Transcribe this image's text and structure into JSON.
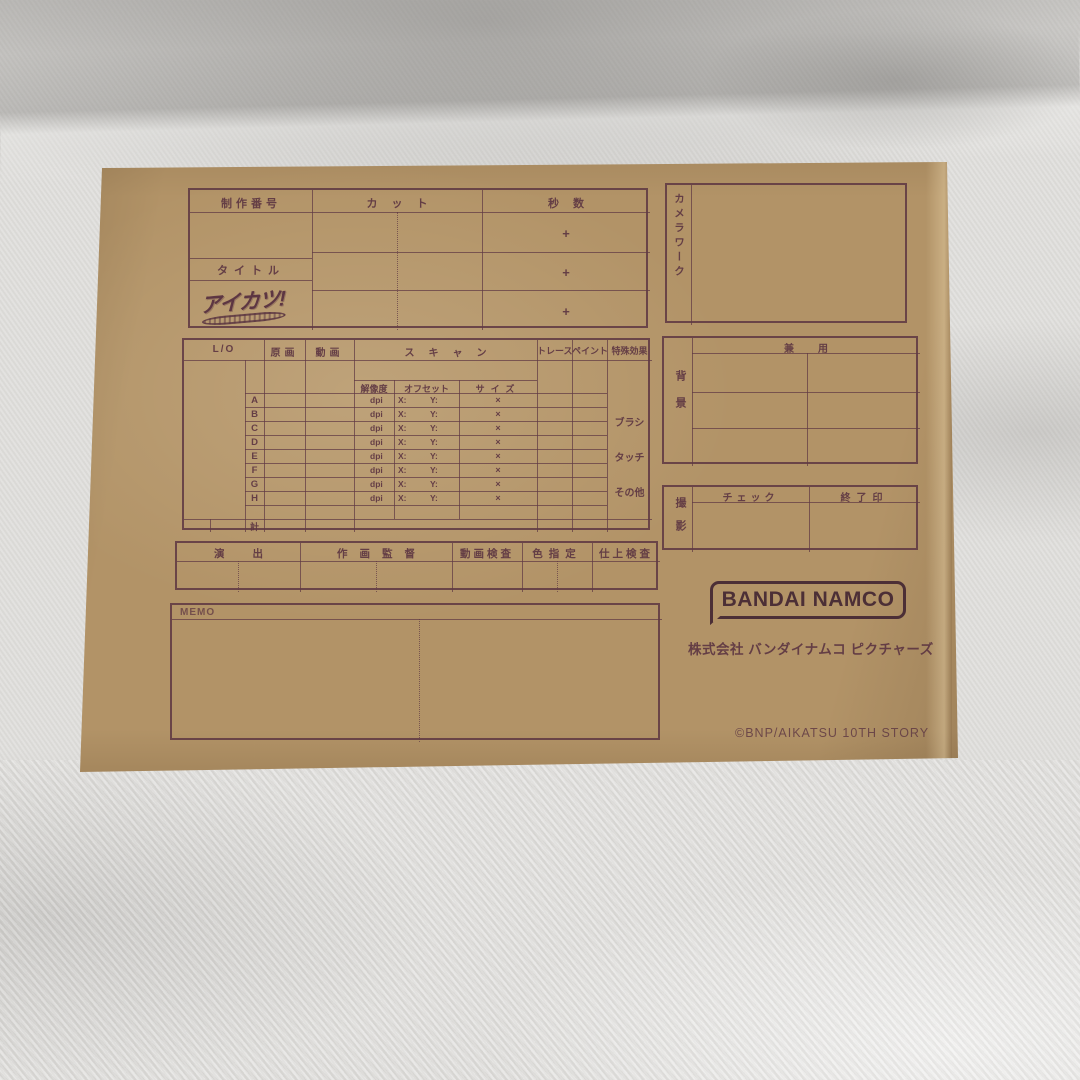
{
  "top_table": {
    "production_no_label": "制作番号",
    "cut_label": "カット",
    "seconds_label": "秒数",
    "title_label": "タイトル",
    "plus_sign": "+",
    "aikatsu_logo_text": "アイカツ!"
  },
  "camera_work_box": {
    "label": "カメラワーク"
  },
  "middle_table": {
    "headers": {
      "layout": "L/O",
      "key_animation": "原画",
      "inbetween": "動画",
      "scan": "スキャン",
      "trace": "トレース",
      "paint": "ペイント",
      "special_effects": "特殊効果"
    },
    "scan_subheaders": {
      "resolution": "解像度",
      "offset": "オフセット",
      "size": "サイズ"
    },
    "row_letters": [
      "A",
      "B",
      "C",
      "D",
      "E",
      "F",
      "G",
      "H"
    ],
    "dpi_label": "dpi",
    "offset_x_label": "X:",
    "offset_y_label": "Y:",
    "size_mark": "×",
    "total_label": "計",
    "effect_items": {
      "brush": "ブラシ",
      "touch": "タッチ",
      "other": "その他"
    }
  },
  "background_box": {
    "label": "背景",
    "header": "兼用"
  },
  "shooting_box": {
    "label": "撮影",
    "check_label": "チェック",
    "finish_stamp_label": "終了印"
  },
  "staff_row": {
    "direction": "演出",
    "animation_director": "作画監督",
    "inbetween_check": "動画検査",
    "color_design": "色指定",
    "finish_check": "仕上検査"
  },
  "memo_box": {
    "label": "MEMO"
  },
  "branding": {
    "logo_text": "BANDAI NAMCO",
    "company": "株式会社 バンダイナムコ ピクチャーズ",
    "copyright": "©BNP/AIKATSU 10TH STORY"
  },
  "colors": {
    "ink": "#5d3642",
    "envelope": "#b29367",
    "fabric": "#dedddb"
  }
}
